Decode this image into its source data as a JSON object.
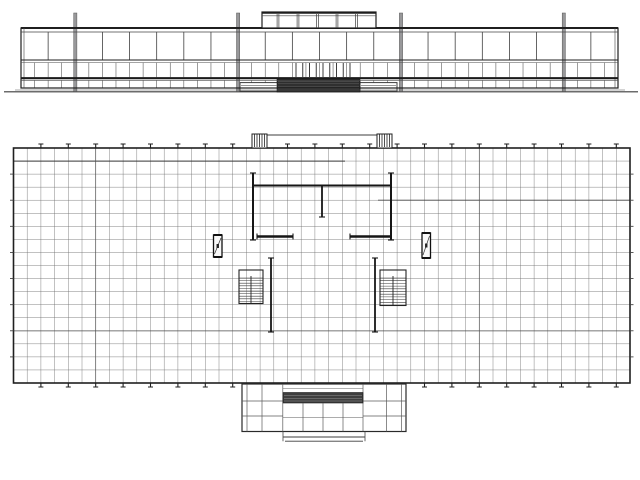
{
  "drawing": {
    "canvas": {
      "w": 640,
      "h": 480
    },
    "colors": {
      "paper": "#ffffff",
      "ink": "#1f1f1f",
      "mid": "#3c3c3c",
      "light": "#5a5a5a",
      "grid": "#6f6f6f",
      "post_grey": "#98989a",
      "hatch_dark": "#2e2e2e",
      "band_dark": "#3e3e3e"
    },
    "elevation": {
      "ground": {
        "x1": 4,
        "x2": 638,
        "y": 91.8
      },
      "facade": {
        "x": 21,
        "y": 28,
        "w": 597,
        "h": 60
      },
      "inner_top_y": 32,
      "edge_inset": 3,
      "transom_y": 60,
      "transom2_y": 62.6,
      "sill_y": 78.2,
      "sill2_y": 80.4,
      "upper_bays": 22,
      "lower_bays": 44,
      "upper_y1": 32,
      "upper_y2": 60,
      "lower_y1": 62.6,
      "lower_y2": 77.2,
      "strip_y1": 80.4,
      "strip_y2": 87.6,
      "posts": {
        "xs": [
          75.3,
          238.1,
          401.0,
          563.8
        ],
        "y1": 13,
        "y2": 91.5,
        "w": 3.2
      },
      "clerestory": {
        "x": 262,
        "y": 12,
        "w": 114,
        "h": 16,
        "inner_y": 15.8,
        "mullions": [
          278,
          298,
          317.5,
          337,
          356.5
        ]
      },
      "hatch": {
        "x": 277,
        "y": 79,
        "w": 83,
        "h": 13,
        "lines": [
          81.4,
          83.8,
          86.2,
          88.6
        ]
      },
      "platforms": [
        {
          "x": 240,
          "y": 82.6,
          "w": 37.5,
          "h": 8.6
        },
        {
          "x": 360,
          "y": 82.6,
          "w": 37.0,
          "h": 8.6
        }
      ],
      "platform_lines": [
        85.4,
        88.0
      ],
      "doors": {
        "x1": 296,
        "x2": 350,
        "count": 9,
        "y1": 63,
        "y2": 77
      }
    },
    "plan": {
      "rect": {
        "x": 13.5,
        "y": 148,
        "w": 616.5,
        "h": 235
      },
      "cols": 45,
      "rows": 18,
      "tick_cols_step": 2,
      "tick_len": 4,
      "tick_cap": 5,
      "side_tick_rows_step": 2,
      "side_tick_len": 3.5,
      "accents": [
        {
          "o": "h",
          "y": 161.1,
          "x1": 13.5,
          "x2": 345,
          "w": 1.0,
          "c": "#3a3a3a"
        },
        {
          "o": "h",
          "y": 200.2,
          "x1": 378,
          "x2": 630,
          "w": 0.9,
          "c": "#424242"
        },
        {
          "o": "h",
          "y": 330.9,
          "x1": 13.5,
          "x2": 630,
          "w": 0.7,
          "c": "#4d4d4d"
        },
        {
          "o": "v",
          "x": 95.7,
          "y1": 148,
          "y2": 383,
          "w": 0.7,
          "c": "#525252"
        },
        {
          "o": "v",
          "x": 479.3,
          "y1": 148,
          "y2": 383,
          "w": 0.7,
          "c": "#525252"
        }
      ],
      "north_porch": {
        "y_top": 135,
        "x1": 252,
        "x2": 392,
        "box_w": 15,
        "box_h": 13,
        "hatch_n": 5
      },
      "walls": [
        {
          "x1": 253,
          "y1": 173,
          "x2": 253,
          "y2": 240,
          "w": 2.0,
          "cap": "both"
        },
        {
          "x1": 391,
          "y1": 173,
          "x2": 391,
          "y2": 240,
          "w": 2.0,
          "cap": "both"
        },
        {
          "x1": 253,
          "y1": 185.5,
          "x2": 391,
          "y2": 185.5,
          "w": 2.0,
          "cap": "none"
        },
        {
          "x1": 322,
          "y1": 186,
          "x2": 322,
          "y2": 217,
          "w": 1.8,
          "cap": "end"
        },
        {
          "x1": 257,
          "y1": 236.5,
          "x2": 293,
          "y2": 236.5,
          "w": 2.4,
          "cap": "both"
        },
        {
          "x1": 350,
          "y1": 236.5,
          "x2": 391,
          "y2": 236.5,
          "w": 2.4,
          "cap": "both"
        },
        {
          "x1": 271,
          "y1": 258,
          "x2": 271,
          "y2": 332,
          "w": 1.8,
          "cap": "both"
        },
        {
          "x1": 375,
          "y1": 258,
          "x2": 375,
          "y2": 332,
          "w": 1.8,
          "cap": "both"
        }
      ],
      "louvers": [
        {
          "x": 213.5,
          "y": 235,
          "w": 8.5,
          "h": 22
        },
        {
          "x": 422.0,
          "y": 233,
          "w": 8.5,
          "h": 25
        }
      ],
      "stairs": [
        {
          "x": 239,
          "y": 270,
          "w": 24,
          "h": 33.5,
          "stringer_x": 251,
          "tread_y1": 278,
          "tread_step": 2.6
        },
        {
          "x": 380,
          "y": 270,
          "w": 26,
          "h": 35.5,
          "stringer_x": 393,
          "tread_y1": 278,
          "tread_step": 2.7
        }
      ],
      "south_porch": {
        "outer": {
          "x": 242,
          "y": 384,
          "w": 164,
          "h": 47.5
        },
        "left_v": [
          247,
          262,
          282.8
        ],
        "right_v": [
          363,
          386.5,
          401.5
        ],
        "block_h": [
          401,
          416
        ],
        "center": {
          "x1": 283,
          "x2": 363,
          "top_line_y": 388.6,
          "band_y": 392.5,
          "band_h": 10.5,
          "band_lines": [
            395.5,
            398.5,
            401.0
          ],
          "v": [
            303,
            323,
            343
          ],
          "mid_y": 417.5
        },
        "steps": {
          "x1": 283,
          "x2": 365,
          "y1": 437,
          "y2": 441.2
        }
      }
    }
  }
}
